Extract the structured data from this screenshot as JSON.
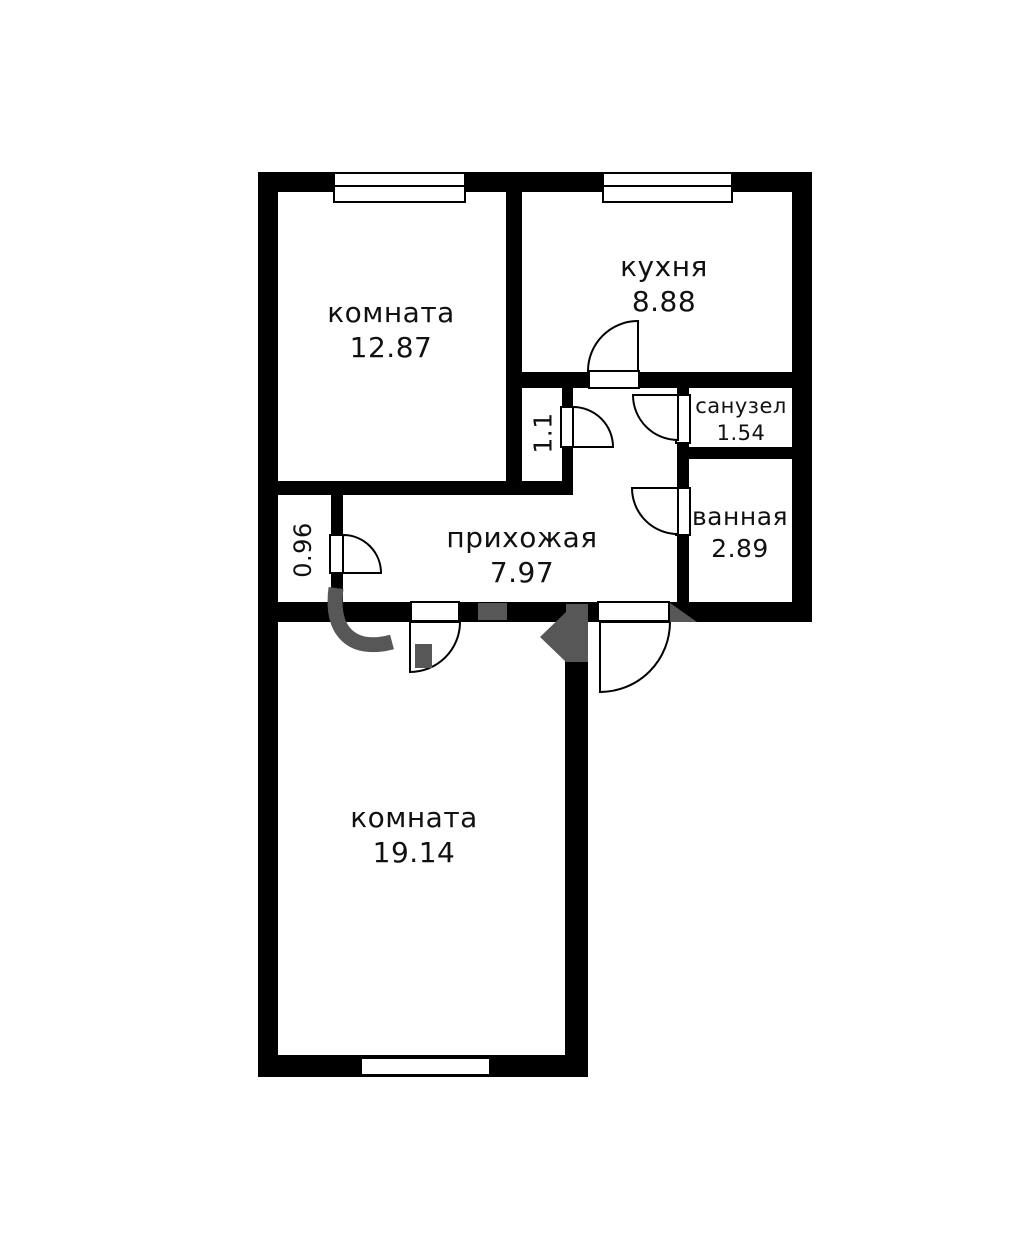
{
  "plan_type": "apartment-floor-plan",
  "language": "ru",
  "rooms": [
    {
      "name": "комната",
      "area": "12.87"
    },
    {
      "name": "кухня",
      "area": "8.88"
    },
    {
      "name": "санузел",
      "area": "1.54"
    },
    {
      "name": "ванная",
      "area": "2.89"
    },
    {
      "name": "прихожая",
      "area": "7.97"
    },
    {
      "name": "комната",
      "area": "19.14"
    },
    {
      "name": "",
      "area": "0.96"
    },
    {
      "name": "",
      "area": "1.1"
    }
  ],
  "colors": {
    "wall": "#000000",
    "floor": "#ffffff",
    "text": "#111111",
    "watermark": "#575757"
  }
}
